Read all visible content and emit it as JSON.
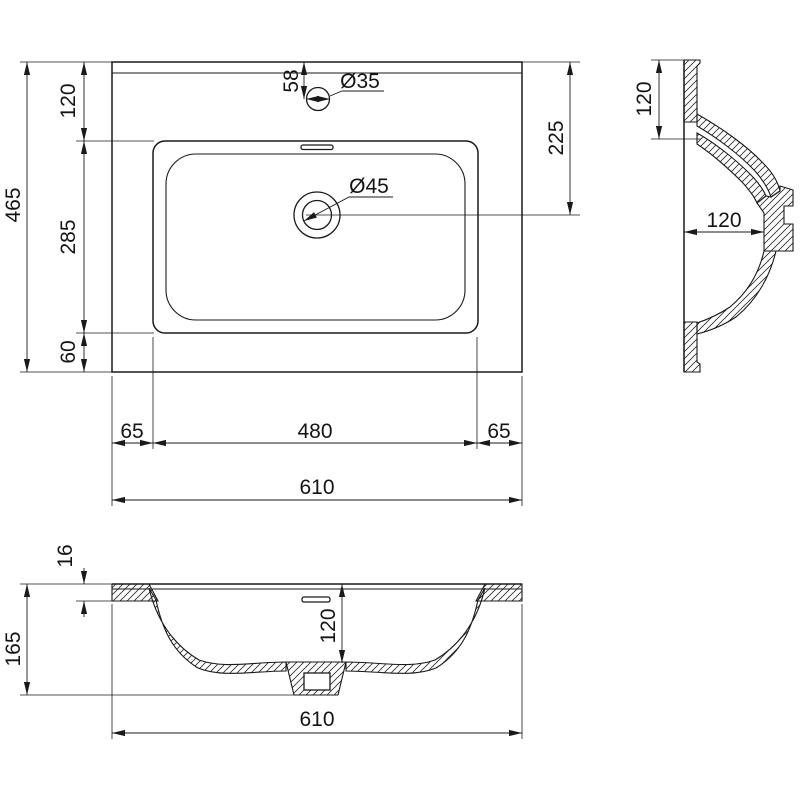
{
  "drawing": {
    "dims": {
      "plan": {
        "total_depth": "465",
        "back_band": "120",
        "basin_depth": "285",
        "front_band": "60",
        "tap_offset": "58",
        "tap_hole": "Ø35",
        "drain_hole": "Ø45",
        "drain_offset": "225",
        "margin_left": "65",
        "basin_width": "480",
        "margin_right": "65",
        "total_width": "610"
      },
      "side": {
        "upper_height": "120",
        "outlet_depth": "120"
      },
      "front": {
        "deck_thickness": "16",
        "total_height": "165",
        "bowl_depth": "120",
        "total_width": "610"
      }
    },
    "colors": {
      "line": "#1a1a1a",
      "background": "#ffffff"
    }
  }
}
